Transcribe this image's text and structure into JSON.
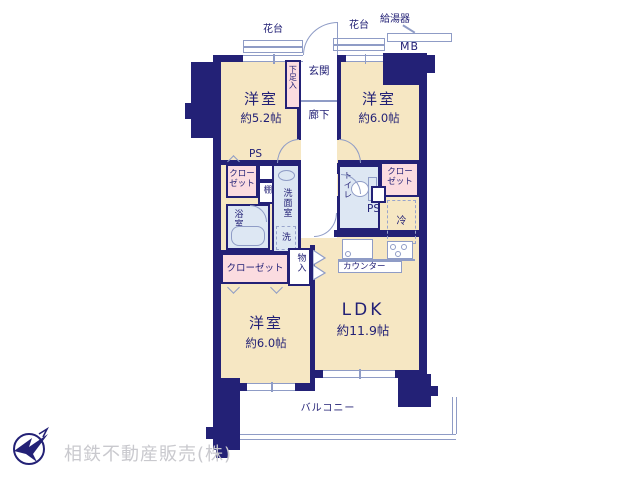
{
  "floorplan": {
    "exterior": {
      "flower_box_left": "花台",
      "flower_box_right": "花台",
      "water_heater": "給湯器",
      "meter_box": "MB",
      "balcony": "バルコニー"
    },
    "entry": {
      "entrance": "玄関",
      "shoe_cabinet": "下足入",
      "hallway": "廊下"
    },
    "rooms": {
      "bedroom_top_left": {
        "name": "洋室",
        "size": "約5.2帖"
      },
      "bedroom_top_right": {
        "name": "洋室",
        "size": "約6.0帖"
      },
      "bedroom_bottom": {
        "name": "洋室",
        "size": "約6.0帖"
      },
      "ldk": {
        "name": "LDK",
        "size": "約11.9帖"
      }
    },
    "utility": {
      "closet_left": "クローゼット",
      "closet_right": "クローゼット",
      "closet_bottom": "クローゼット",
      "shelf": "棚",
      "bathroom": "浴室",
      "washroom": "洗面室",
      "washer": "洗",
      "toilet": "トイレ",
      "refrigerator": "冷",
      "pipe_space_left": "PS",
      "pipe_space_right": "PS",
      "counter": "カウンター",
      "storage": "物入"
    },
    "colors": {
      "wall": "#232176",
      "room_floor": "#f6e7c3",
      "closet_pink": "#fbdce0",
      "wet_area_blue": "#dde7f3",
      "fixture_line": "#8f9cc6",
      "footer_gray": "#c9c9ce"
    }
  },
  "footer": {
    "company": "相鉄不動産販売(株)"
  }
}
